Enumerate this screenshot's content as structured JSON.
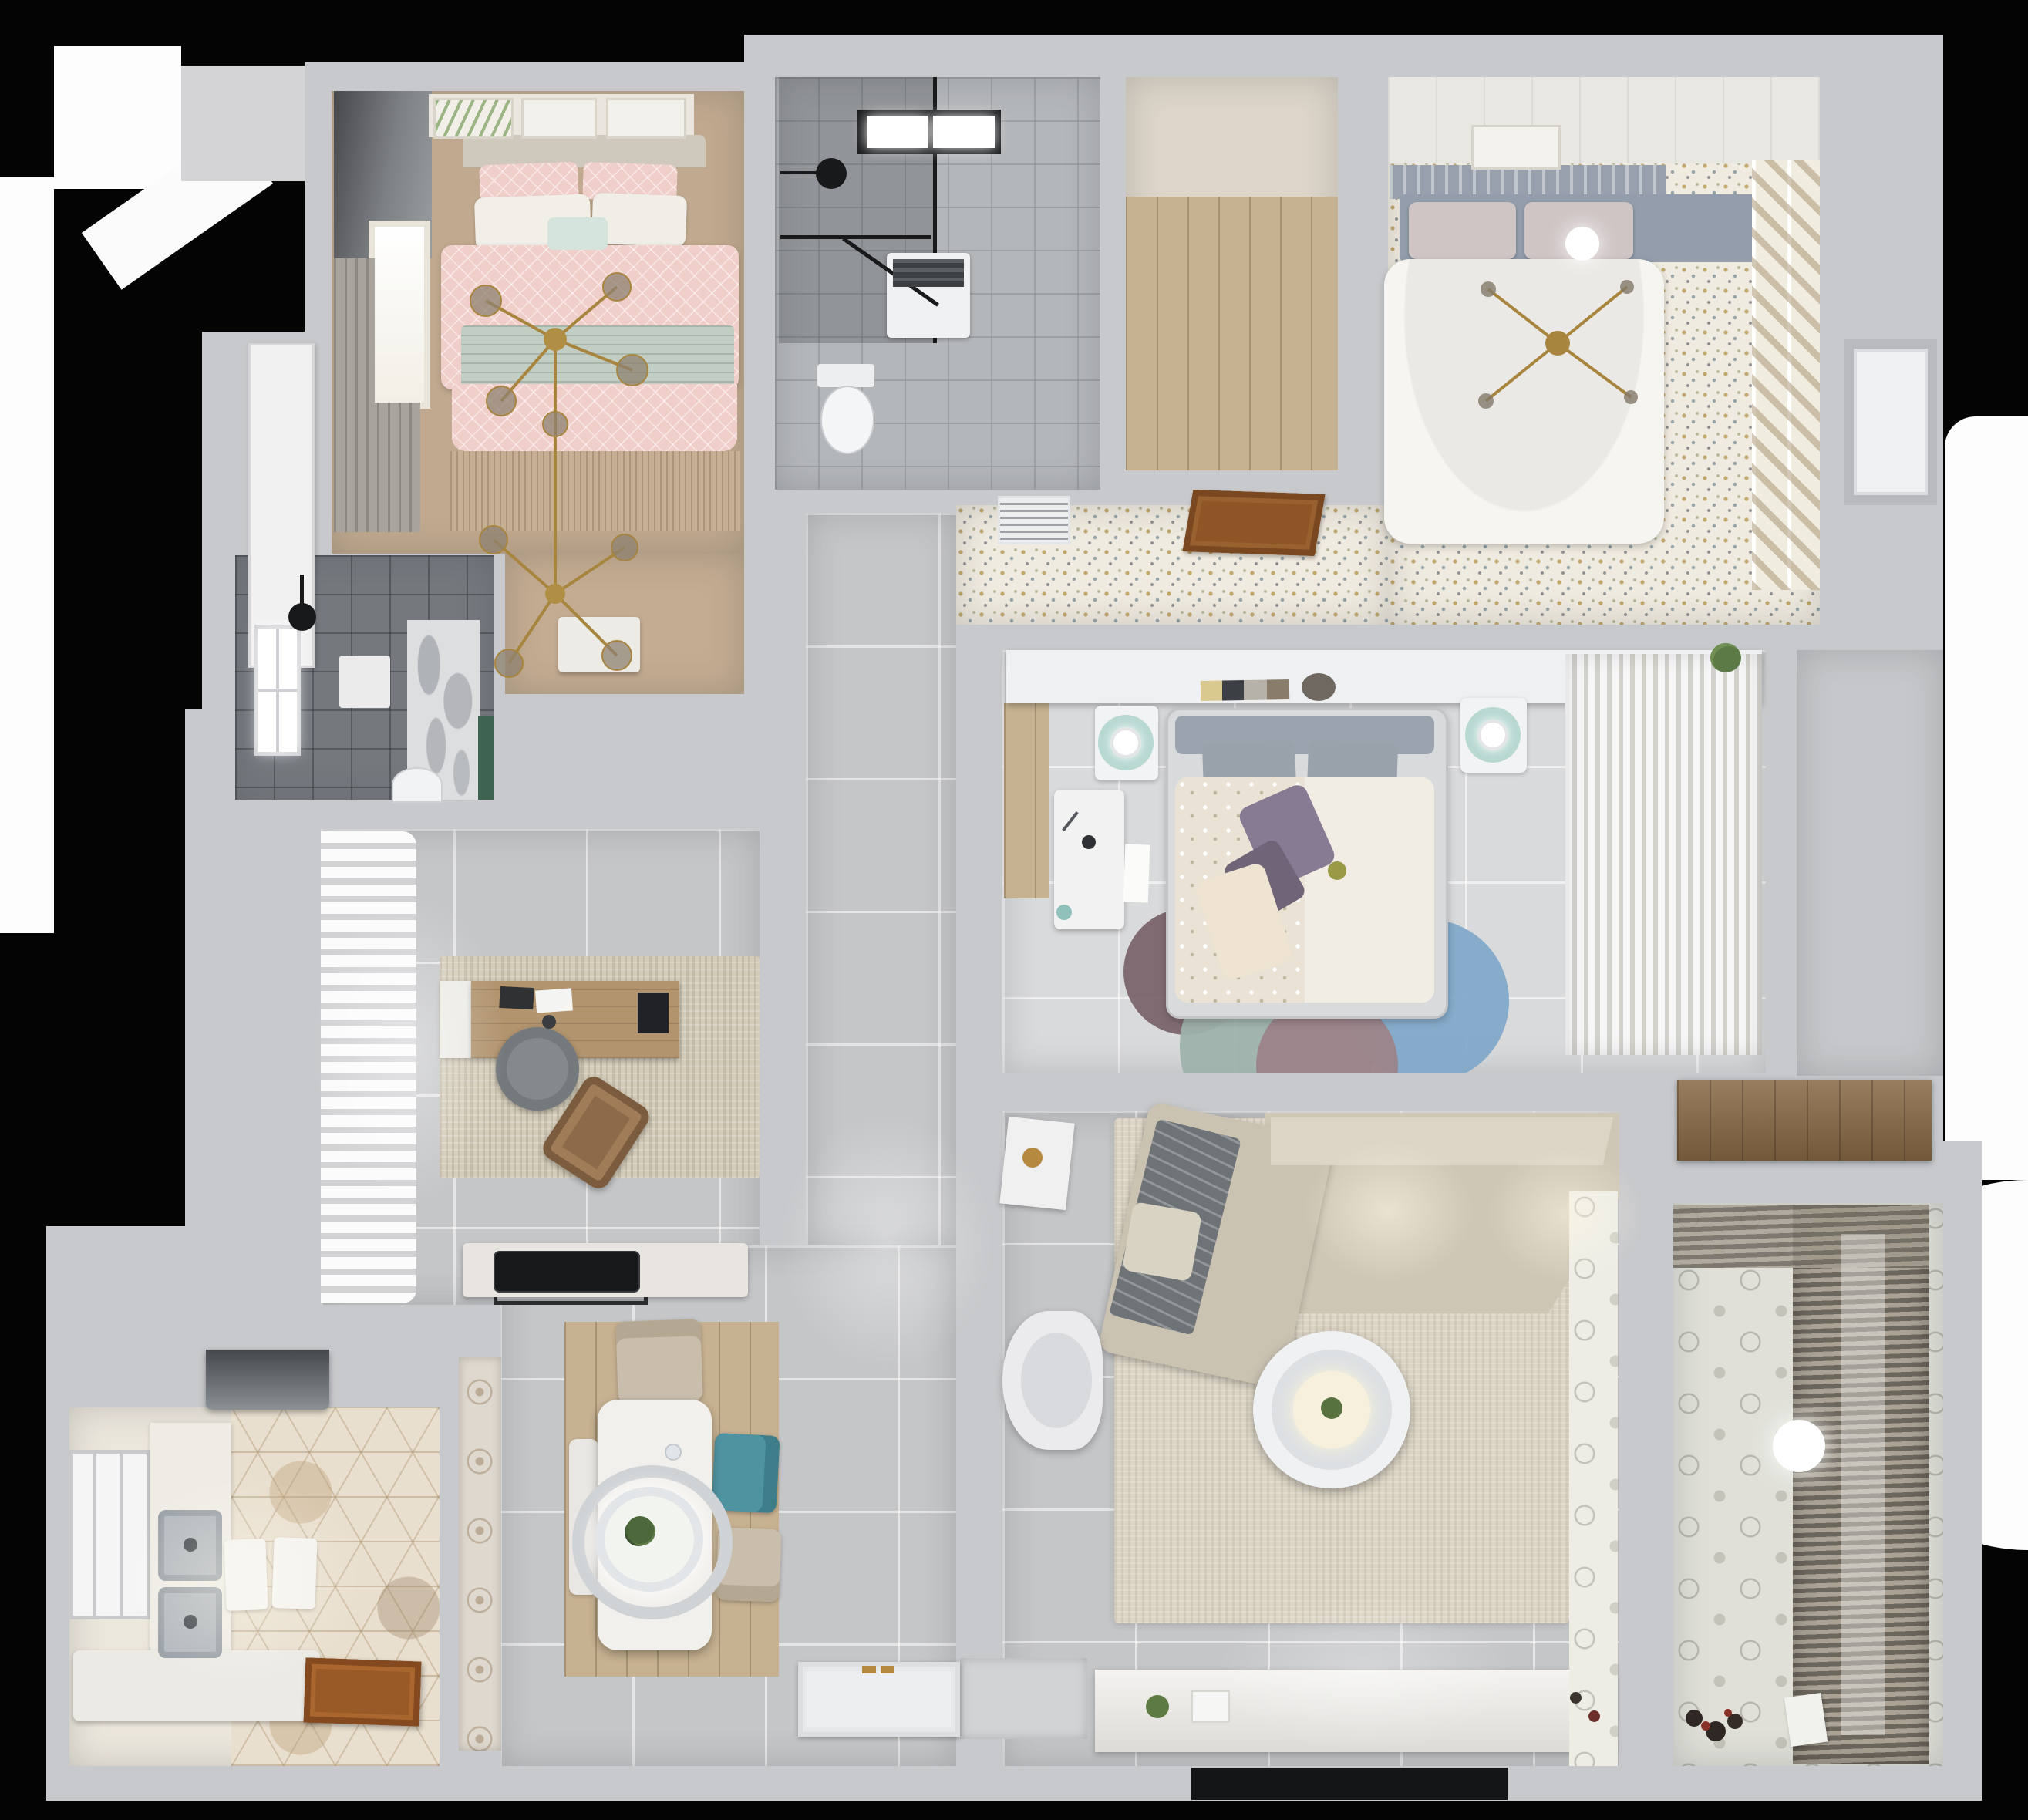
{
  "meta": {
    "description": "Top-down 3D render of a furnished apartment floor plan",
    "view": "top-down",
    "visible_text": "none",
    "background": "#040404"
  },
  "palette": {
    "wall": "#c8c9cc",
    "floor_tile_gray": "#c5c6c8",
    "floor_tile_pale": "#d9dadc",
    "bathroom_tile_light": "#b4b7ba",
    "bathroom_tile_dark": "#75797e",
    "wood_light": "#c6b191",
    "speckle_floor": "#f0ebe0",
    "hex_tile": "#e9dfcf",
    "balcony_tile": "#e0e0d9",
    "pink_bedding": "#f0cfcb",
    "sage_blanket": "#c2cec4",
    "teal_chair": "#4f93a0",
    "gold_fixture": "#a8853f",
    "dark_fixture": "#17191b",
    "sofa_beige": "#cfc7b6",
    "rug_blue": "#82a9c9",
    "rug_mauve": "#9c8489",
    "rug_teal": "#9eb2ab",
    "rug_plum": "#7c656c"
  },
  "rooms": {
    "master_bedroom": {
      "name": "Bedroom — pink (top left)",
      "floor": "tan wood",
      "furniture": [
        "double bed with pink patterned duvet",
        "sage green blanket",
        "pink and white pillows",
        "teal accent pillow",
        "gold branch chandelier with glass globes",
        "three framed artworks",
        "roman blind window",
        "fringed tan rug",
        "white bedside bench",
        "tall white cabinet door outside"
      ]
    },
    "main_bathroom": {
      "name": "Bathroom — shower room (top middle)",
      "floor": "light gray tile",
      "furniture": [
        "black framed glass shower enclosure",
        "black rain shower head",
        "skylight window",
        "washing machine",
        "toilet"
      ]
    },
    "walkin_closet": {
      "name": "Walk-in closet (top middle right)",
      "floor": "light wood planks",
      "furniture": []
    },
    "bedroom_white": {
      "name": "Bedroom — white (top right)",
      "floor": "speckled terrazzo",
      "furniture": [
        "double bed with white duvet",
        "gray slatted headboard bench",
        "two mauve pillows",
        "glowing ceiling lamp",
        "gold cross chandelier",
        "framed artwork",
        "diagonal slat shelving column",
        "white paneled wall"
      ]
    },
    "hallway": {
      "name": "Hallway by white bedroom",
      "floor": "speckled terrazzo",
      "furniture": [
        "white AC vent grille",
        "open wooden door"
      ]
    },
    "guest_bathroom": {
      "name": "Bathroom — dark tile (middle left)",
      "floor": "dark gray tile",
      "furniture": [
        "window",
        "black shower head",
        "marble feature wall",
        "green accent strip",
        "white shelf",
        "toilet"
      ]
    },
    "home_office": {
      "name": "Home office (middle left)",
      "floor": "gray tile",
      "furniture": [
        "white wavy curtain wall",
        "wooden desk",
        "white desk return",
        "monitor",
        "laptop",
        "papers",
        "gray round office chair",
        "brown lounge chair",
        "beige mottled rug",
        "dark doormat"
      ]
    },
    "corridor": {
      "name": "Corridor",
      "floor": "large gray tile",
      "furniture": []
    },
    "bedroom_center": {
      "name": "Bedroom — center",
      "floor": "pale tile",
      "furniture": [
        "bed with floral duvet",
        "purple pillows",
        "gray pillows",
        "headboard shelf with books",
        "two nightstands with teal mats and white lamps",
        "white desk",
        "round rug of overlapping blue, teal, mauve and plum circles",
        "wardrobe with hanging white clothes",
        "wood floor strip",
        "green plant"
      ]
    },
    "living_room": {
      "name": "Living room",
      "floor": "large gray tile",
      "furniture": [
        "L-shaped beige sectional sofa",
        "gray throw blanket",
        "round white coffee table",
        "white armchair",
        "white side table",
        "large beige rug",
        "TV console with plant",
        "wall mounted TV",
        "patterned threshold strip"
      ]
    },
    "kitchen": {
      "name": "Kitchen (bottom left)",
      "floor": "hexagon patterned tile",
      "furniture": [
        "dark range hood",
        "double stainless sink",
        "white counters",
        "tall window",
        "two white mats",
        "open wooden door",
        "peninsula counter with black induction hob"
      ]
    },
    "dining": {
      "name": "Dining area",
      "floor": "gray tile with wood nook",
      "furniture": [
        "white rectangular dining table",
        "oval pendant lamp with green plant",
        "two beige chairs",
        "teal chair",
        "white bench",
        "patterned open shelving strip"
      ]
    },
    "balcony": {
      "name": "Balcony / laundry (bottom right)",
      "floor": "geometric patterned tile",
      "furniture": [
        "venetian blinds window wall",
        "round ceiling lamp",
        "toys on floor",
        "white papers"
      ]
    },
    "storage_nook": {
      "name": "Storage nook (right)",
      "floor": "gray",
      "furniture": [
        "long wooden sideboard",
        "white interior door"
      ]
    },
    "entry": {
      "name": "Entry",
      "floor": "gray tile",
      "furniture": [
        "white entry door leaf with gold hinges",
        "threshold niche"
      ]
    }
  },
  "lighting": [
    "bedroom chandeliers",
    "balcony ceiling lamp",
    "dining pendant",
    "sofa downlights",
    "window daylight"
  ]
}
